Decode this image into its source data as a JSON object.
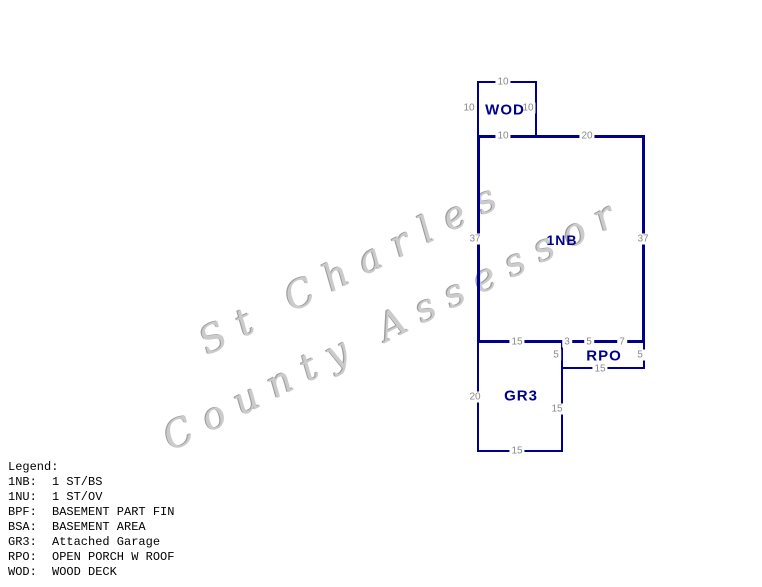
{
  "watermark": {
    "line1": "St Charles",
    "line2": "County Assessor"
  },
  "colors": {
    "outline": "#00008B",
    "area_label": "#00008B",
    "dimension_text": "#8a8a8a",
    "legend_text": "#000000",
    "watermark_text": "#cbcbcb",
    "background": "#ffffff"
  },
  "sketch": {
    "areas": [
      {
        "id": "wod",
        "label": "WOD"
      },
      {
        "id": "1nb",
        "label": "1NB"
      },
      {
        "id": "gr3",
        "label": "GR3"
      },
      {
        "id": "rpo",
        "label": "RPO"
      }
    ],
    "dimensions": [
      {
        "text": "10"
      },
      {
        "text": "10"
      },
      {
        "text": "10"
      },
      {
        "text": "10"
      },
      {
        "text": "20"
      },
      {
        "text": "37"
      },
      {
        "text": "37"
      },
      {
        "text": "15"
      },
      {
        "text": "3"
      },
      {
        "text": "5"
      },
      {
        "text": "7"
      },
      {
        "text": "5"
      },
      {
        "text": "5"
      },
      {
        "text": "15"
      },
      {
        "text": "20"
      },
      {
        "text": "15"
      },
      {
        "text": "15"
      }
    ]
  },
  "legend": {
    "title": "Legend:",
    "items": [
      {
        "key": "1NB:",
        "value": "1 ST/BS"
      },
      {
        "key": "1NU:",
        "value": "1 ST/OV"
      },
      {
        "key": "BPF:",
        "value": "BASEMENT PART FIN"
      },
      {
        "key": "BSA:",
        "value": "BASEMENT AREA"
      },
      {
        "key": "GR3:",
        "value": "Attached Garage"
      },
      {
        "key": "RPO:",
        "value": "OPEN PORCH W ROOF"
      },
      {
        "key": "WOD:",
        "value": "WOOD DECK"
      }
    ]
  }
}
